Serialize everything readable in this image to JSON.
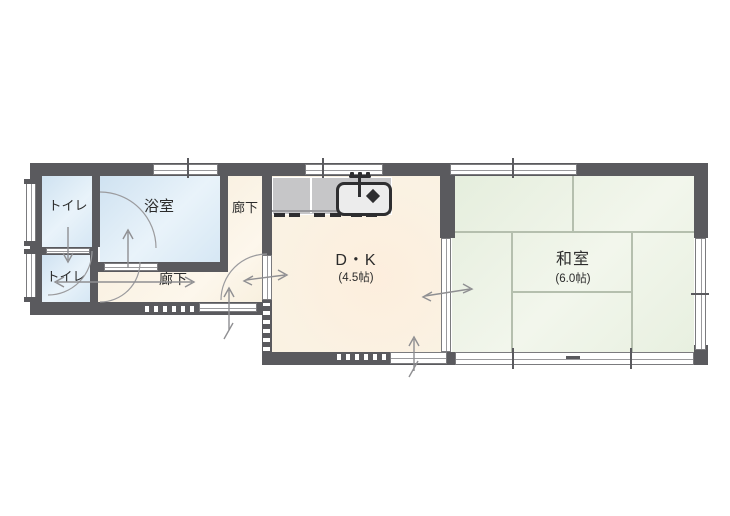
{
  "floorplan": {
    "rooms": {
      "toilet_upper": {
        "label": "トイレ"
      },
      "toilet_lower": {
        "label": "トイレ"
      },
      "bathroom": {
        "label": "浴室"
      },
      "hallway_upper": {
        "label": "廊下"
      },
      "hallway_main": {
        "label": "廊下"
      },
      "dining_kitchen": {
        "label": "D・K",
        "size": "(4.5帖)"
      },
      "japanese_room": {
        "label": "和室",
        "size": "(6.0帖)"
      }
    },
    "colors": {
      "wall": "#5a5a5e",
      "water_rooms": "#d8e8f4",
      "corridor": "#faf3e4",
      "dining_kitchen": "#fbf0e0",
      "tatami_room": "#ebf2e3",
      "tatami_line": "#b5bfae",
      "kitchen_counter": "#c6c6c8",
      "window": "#ffffff",
      "arrow": "#8f8f92"
    }
  }
}
